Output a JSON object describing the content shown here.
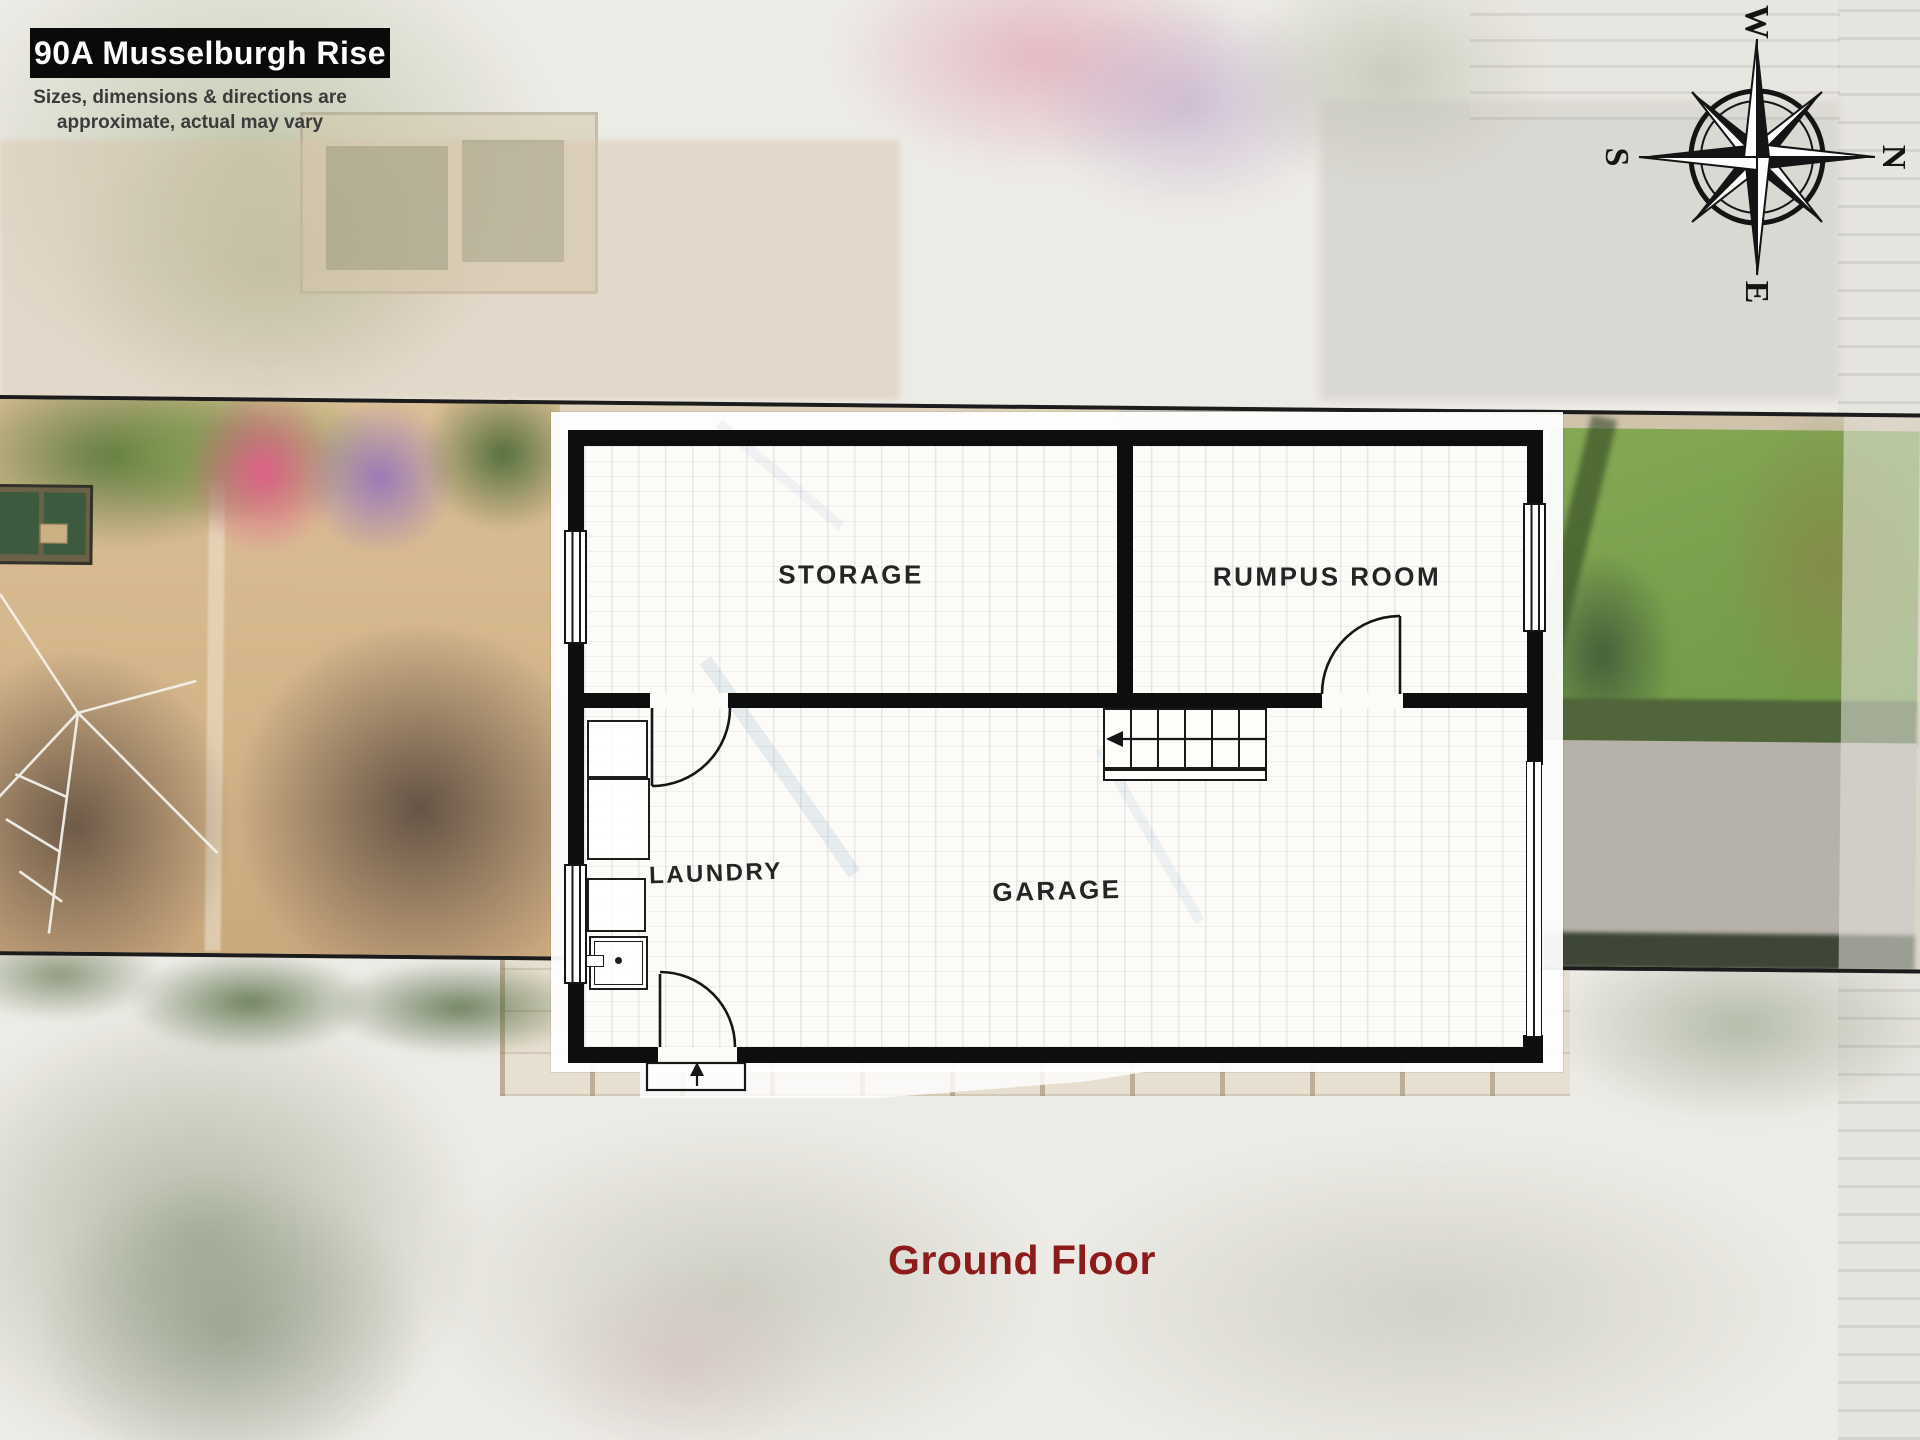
{
  "header": {
    "title": "90A Musselburgh Rise",
    "disclaimer_line1": "Sizes, dimensions & directions are",
    "disclaimer_line2": "approximate, actual may vary"
  },
  "compass": {
    "north": "N",
    "east": "E",
    "south": "S",
    "west": "W"
  },
  "floorplan": {
    "rooms": [
      {
        "name": "STORAGE"
      },
      {
        "name": "RUMPUS ROOM"
      },
      {
        "name": "LAUNDRY"
      },
      {
        "name": "GARAGE"
      }
    ]
  },
  "footer": {
    "floor_label": "Ground Floor"
  },
  "colors": {
    "wall": "#0e0e0e",
    "floor_label_color": "#8e1b1b",
    "title_bg": "#0a0a0a",
    "title_fg": "#ffffff",
    "disclaimer_fg": "#3b3b3b"
  }
}
